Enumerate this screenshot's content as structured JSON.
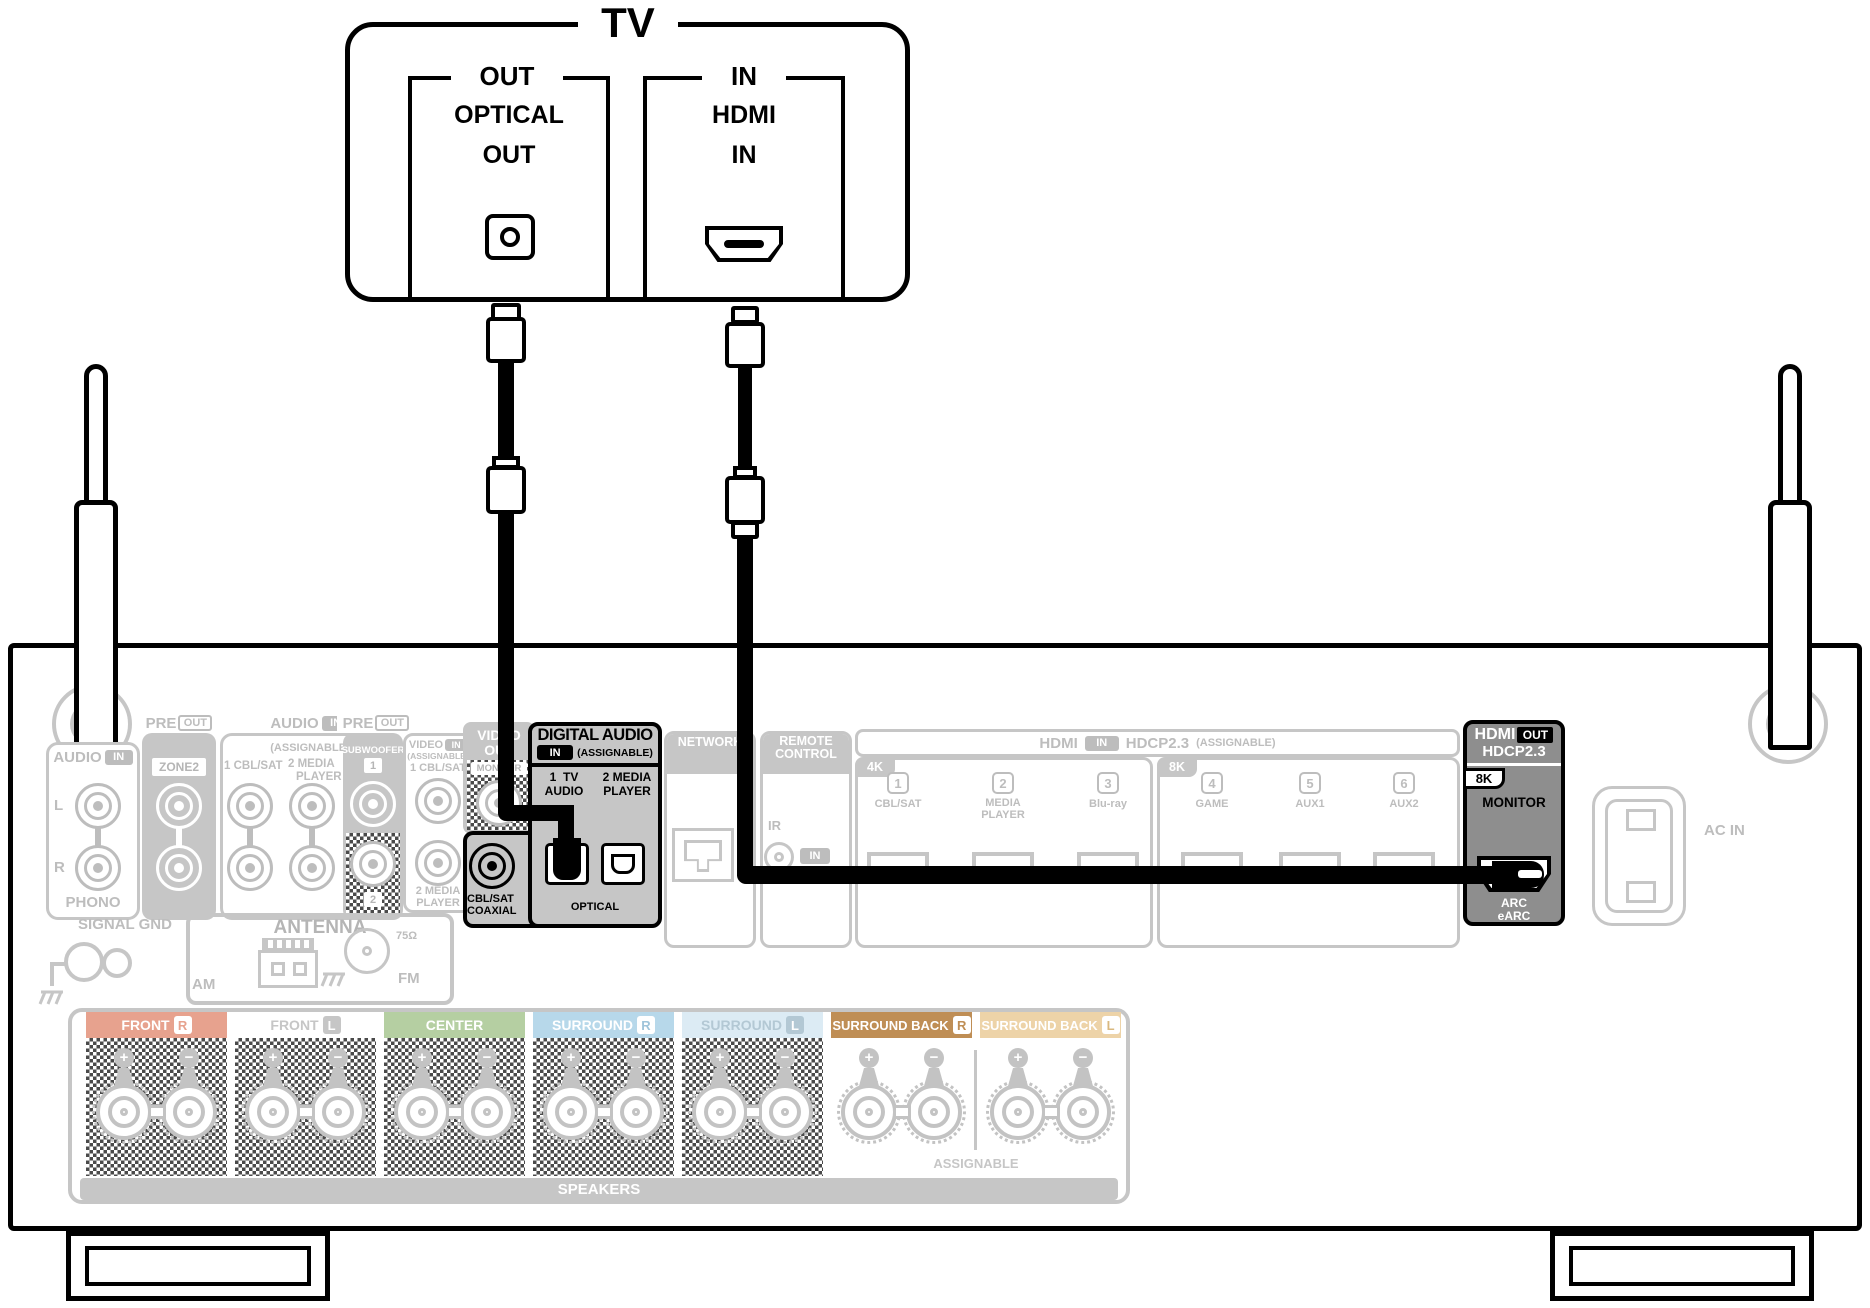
{
  "tv": {
    "title": "TV",
    "optical": {
      "header": "OUT",
      "line1": "OPTICAL",
      "line2": "OUT"
    },
    "hdmi": {
      "header": "IN",
      "line1": "HDMI",
      "line2": "IN"
    }
  },
  "rx": {
    "phono": {
      "label": "AUDIO",
      "chip": "IN",
      "left": "L",
      "right": "R",
      "caption": "PHONO"
    },
    "zone2": {
      "label": "PRE",
      "chip": "OUT",
      "name": "ZONE2"
    },
    "audio_assign": {
      "label": "AUDIO",
      "chip": "IN",
      "sub": "(ASSIGNABLE)",
      "col1": "1 CBL/SAT",
      "col2a": "2 MEDIA",
      "col2b": "PLAYER"
    },
    "sub_pre": {
      "label": "PRE",
      "chip": "OUT",
      "name": "SUBWOOFER",
      "jack1": "1",
      "jack2": "2"
    },
    "video_in": {
      "label": "VIDEO",
      "chip": "IN",
      "sub": "(ASSIGNABLE)",
      "jack1": "1 CBL/SAT",
      "jack2a": "2 MEDIA",
      "jack2b": "PLAYER"
    },
    "video_out": {
      "label1": "VIDEO",
      "label2": "OUT",
      "name": "MONITOR"
    },
    "digital": {
      "title": "DIGITAL AUDIO",
      "chip": "IN",
      "sub": "(ASSIGNABLE)",
      "port1a": "1  TV",
      "port1b": "AUDIO",
      "port2a": "2 MEDIA",
      "port2b": "PLAYER",
      "coax1": "CBL/SAT",
      "coax2": "COAXIAL",
      "optical": "OPTICAL"
    },
    "network": {
      "label": "NETWORK"
    },
    "remote": {
      "label1": "REMOTE",
      "label2": "CONTROL",
      "ir": "IR",
      "chip": "IN"
    },
    "hdmi_in": {
      "label": "HDMI",
      "chip": "IN",
      "hdcp": "HDCP2.3",
      "sub": "(ASSIGNABLE)",
      "tab4k": "4K",
      "tab8k": "8K",
      "ports": [
        {
          "num": "1",
          "name": "CBL/SAT"
        },
        {
          "num": "2",
          "name": "MEDIA PLAYER"
        },
        {
          "num": "3",
          "name": "Blu-ray"
        },
        {
          "num": "4",
          "name": "GAME"
        },
        {
          "num": "5",
          "name": "AUX1"
        },
        {
          "num": "6",
          "name": "AUX2"
        }
      ]
    },
    "hdmi_out": {
      "label": "HDMI",
      "chip": "OUT",
      "hdcp": "HDCP2.3",
      "tab": "8K",
      "name": "MONITOR",
      "arc1": "ARC",
      "arc2": "eARC"
    },
    "ac_in": {
      "label": "AC IN"
    },
    "signal_gnd": {
      "label": "SIGNAL GND"
    },
    "antenna": {
      "label": "ANTENNA",
      "am": "AM",
      "fm": "FM",
      "ohm": "75Ω"
    },
    "speakers": {
      "caption": "SPEAKERS",
      "assignable": "ASSIGNABLE",
      "plus": "+",
      "minus": "−",
      "channels": [
        {
          "name": "FRONT",
          "side": "R",
          "bg": "#e7a28e",
          "fg": "#ffffff",
          "chip_bg": "#ffffff",
          "chip_fg": "#e7a28e"
        },
        {
          "name": "FRONT",
          "side": "L",
          "bg": "#ffffff",
          "fg": "#c6c6c6",
          "chip_bg": "#c6c6c6",
          "chip_fg": "#ffffff"
        },
        {
          "name": "CENTER",
          "side": "",
          "bg": "#b5cfa2",
          "fg": "#ffffff",
          "chip_bg": "",
          "chip_fg": ""
        },
        {
          "name": "SURROUND",
          "side": "R",
          "bg": "#b7d8ea",
          "fg": "#ffffff",
          "chip_bg": "#ffffff",
          "chip_fg": "#9fc4da"
        },
        {
          "name": "SURROUND",
          "side": "L",
          "bg": "#dcebf4",
          "fg": "#b3c8d4",
          "chip_bg": "#b3c8d4",
          "chip_fg": "#ffffff"
        },
        {
          "name": "SURROUND BACK",
          "side": "R",
          "bg": "#bf8e55",
          "fg": "#ffffff",
          "chip_bg": "#ffffff",
          "chip_fg": "#bf8e55"
        },
        {
          "name": "SURROUND BACK",
          "side": "L",
          "bg": "#edd3a8",
          "fg": "#ffffff",
          "chip_bg": "#ffffff",
          "chip_fg": "#d9b87f"
        }
      ]
    }
  },
  "colors": {
    "gray": "#c6c6c6",
    "highlight": "#000000",
    "hdmi_out_bg": "#8e8e8e",
    "digital_bg": "#c6c6c6"
  }
}
